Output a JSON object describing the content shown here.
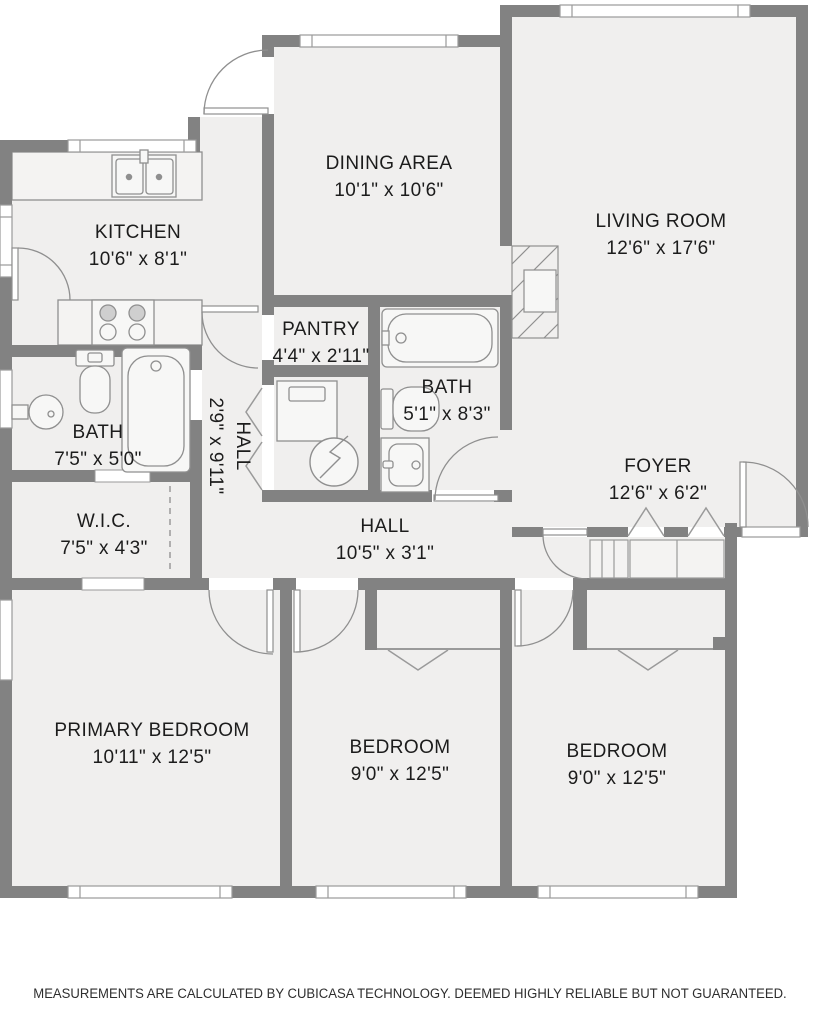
{
  "plan": {
    "rooms": [
      {
        "id": "dining-area",
        "name": "DINING AREA",
        "dims": "10'1\" x 10'6\""
      },
      {
        "id": "living-room",
        "name": "LIVING ROOM",
        "dims": "12'6\" x 17'6\""
      },
      {
        "id": "kitchen",
        "name": "KITCHEN",
        "dims": "10'6\" x 8'1\""
      },
      {
        "id": "pantry",
        "name": "PANTRY",
        "dims": "4'4\" x 2'11\""
      },
      {
        "id": "bath-main",
        "name": "BATH",
        "dims": "5'1\" x 8'3\""
      },
      {
        "id": "bath-left",
        "name": "BATH",
        "dims": "7'5\" x 5'0\""
      },
      {
        "id": "hall-vertical",
        "name": "HALL",
        "dims": "2'9\" x 9'11\""
      },
      {
        "id": "wic",
        "name": "W.I.C.",
        "dims": "7'5\" x 4'3\""
      },
      {
        "id": "hall",
        "name": "HALL",
        "dims": "10'5\" x 3'1\""
      },
      {
        "id": "foyer",
        "name": "FOYER",
        "dims": "12'6\" x 6'2\""
      },
      {
        "id": "primary-bedroom",
        "name": "PRIMARY BEDROOM",
        "dims": "10'11\" x 12'5\""
      },
      {
        "id": "bedroom-2",
        "name": "BEDROOM",
        "dims": "9'0\" x 12'5\""
      },
      {
        "id": "bedroom-3",
        "name": "BEDROOM",
        "dims": "9'0\" x 12'5\""
      }
    ],
    "disclaimer": "MEASUREMENTS ARE CALCULATED BY CUBICASA TECHNOLOGY. DEEMED HIGHLY RELIABLE BUT NOT GUARANTEED.",
    "colors": {
      "wall": "#828282",
      "floor": "#f0efee",
      "fixture_stroke": "#8f8f8f",
      "text": "#1c1c1c"
    }
  }
}
